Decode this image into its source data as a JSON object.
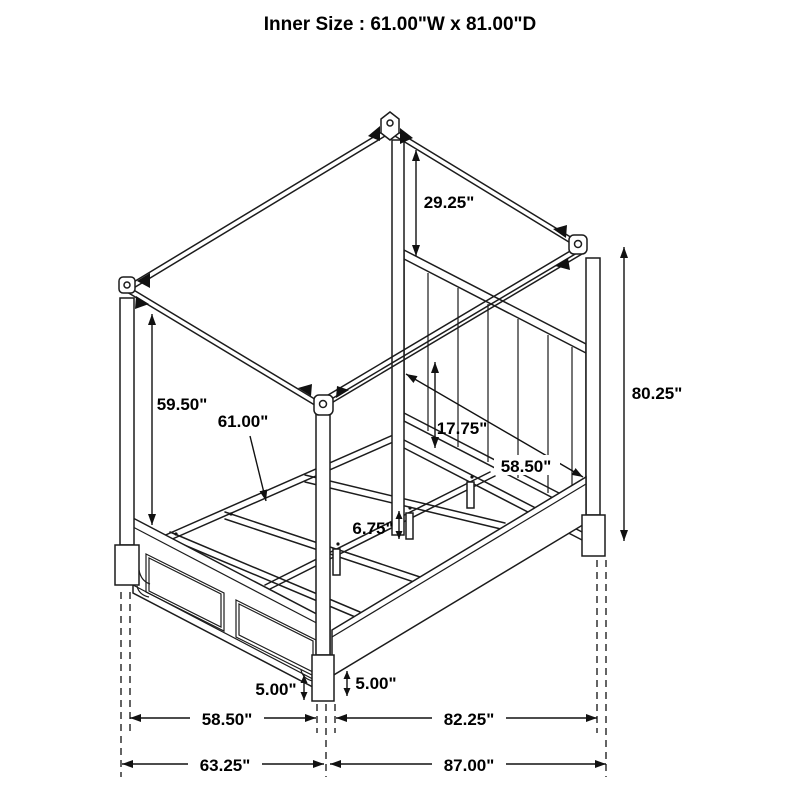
{
  "title": "Inner Size : 61.00\"W x 81.00\"D",
  "diagram": {
    "subject": "canopy-storage-bed-dimension-drawing",
    "labels": {
      "canopy_drop": "29.25\"",
      "overall_height": "80.25\"",
      "post_height": "59.50\"",
      "inner_width": "61.00\"",
      "headboard_clearance": "17.75\"",
      "frame_width": "58.50\"",
      "support_leg_height": "6.75\"",
      "left_ground_clearance": "5.00\"",
      "front_ground_clearance": "5.00\"",
      "base_width": "58.50\"",
      "overall_width": "63.25\"",
      "side_rail_length": "82.25\"",
      "overall_depth": "87.00\""
    }
  }
}
